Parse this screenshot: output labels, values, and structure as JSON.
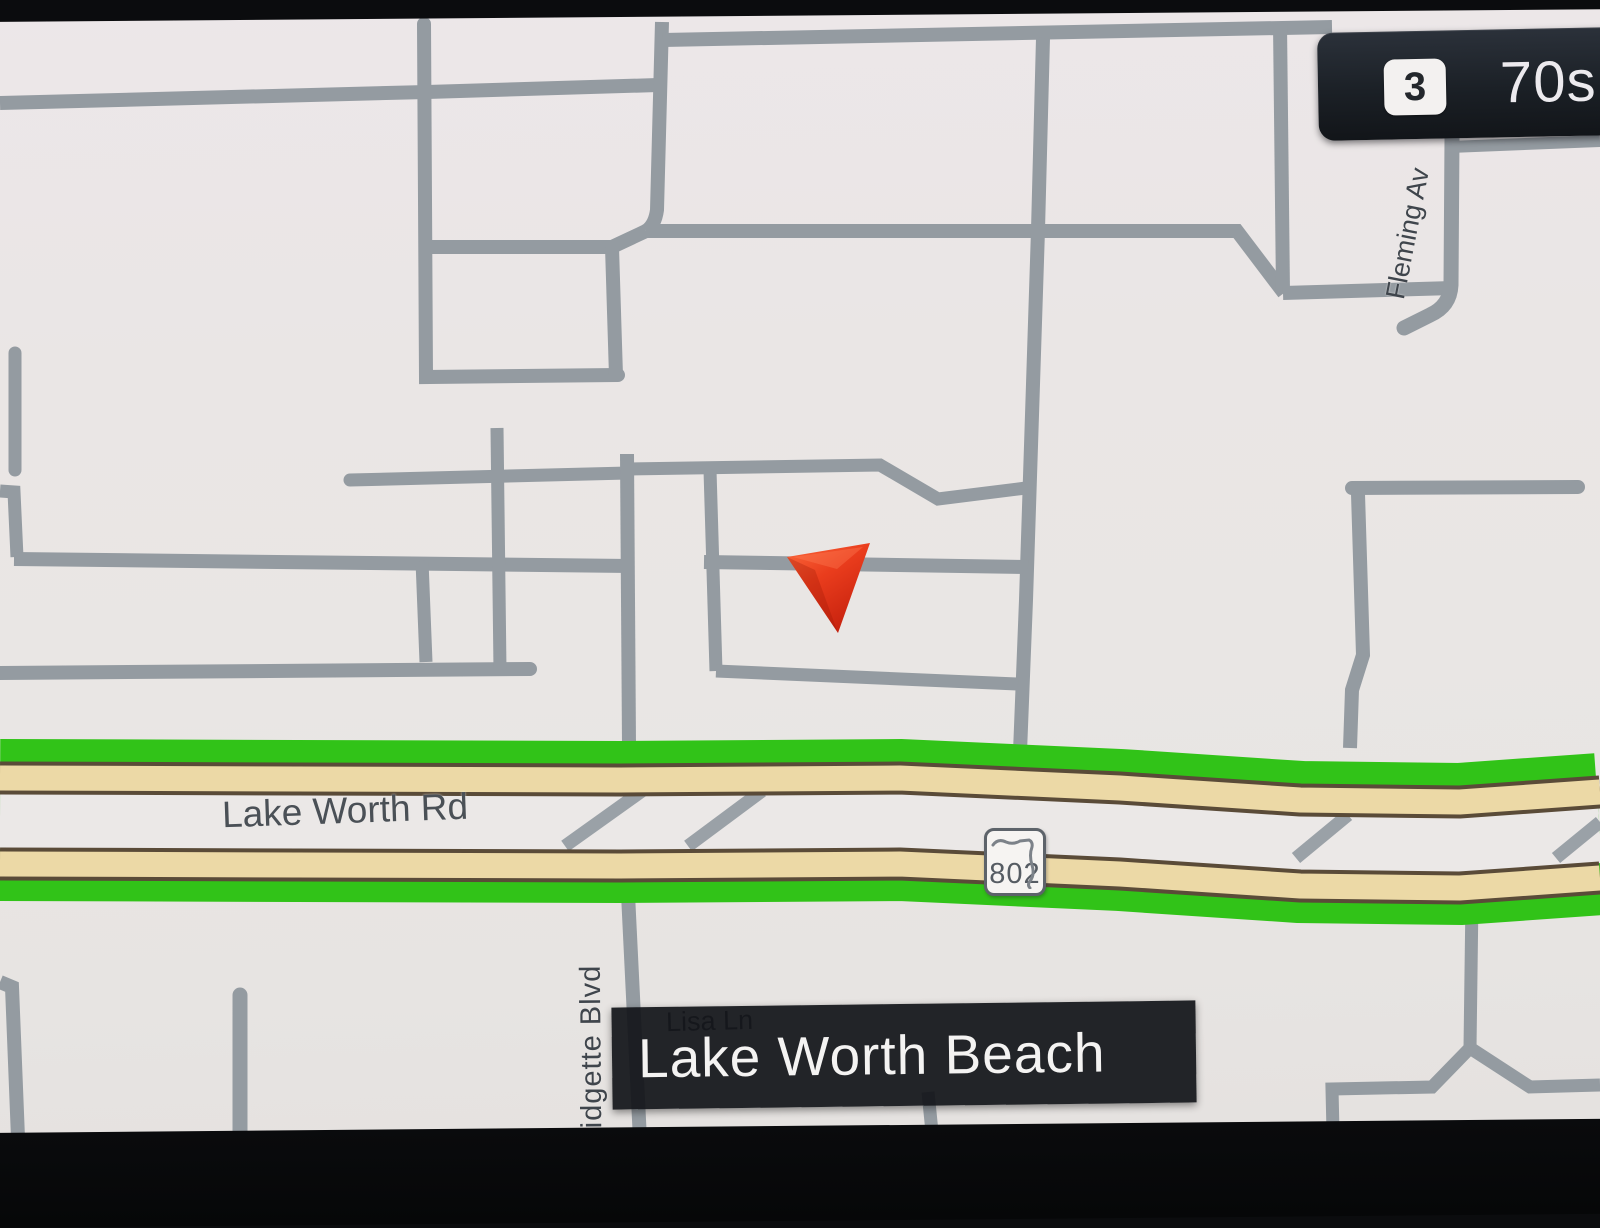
{
  "status_bar": {
    "badge": "3",
    "info": "70s"
  },
  "map": {
    "city": "Lake Worth Beach",
    "shield": {
      "number": "802"
    },
    "labels": {
      "lake_worth_rd": "Lake Worth Rd",
      "lisa_ln": "Lisa Ln",
      "idgette_blvd": "idgette Blvd",
      "fleming_av": "Fleming Av"
    }
  },
  "colors": {
    "route_green": "#31c318",
    "highway_tan": "#ecd9a6",
    "highway_edge_brown": "#5a4b38",
    "road_gray": "#949ba1",
    "arrow_red": "#e03317",
    "overlay_dark": "#15181d",
    "map_background": "#e9e6e4"
  },
  "icons": {
    "vehicle_arrow": "vehicle-position-arrow",
    "route_shield": "florida-state-route-shield"
  }
}
